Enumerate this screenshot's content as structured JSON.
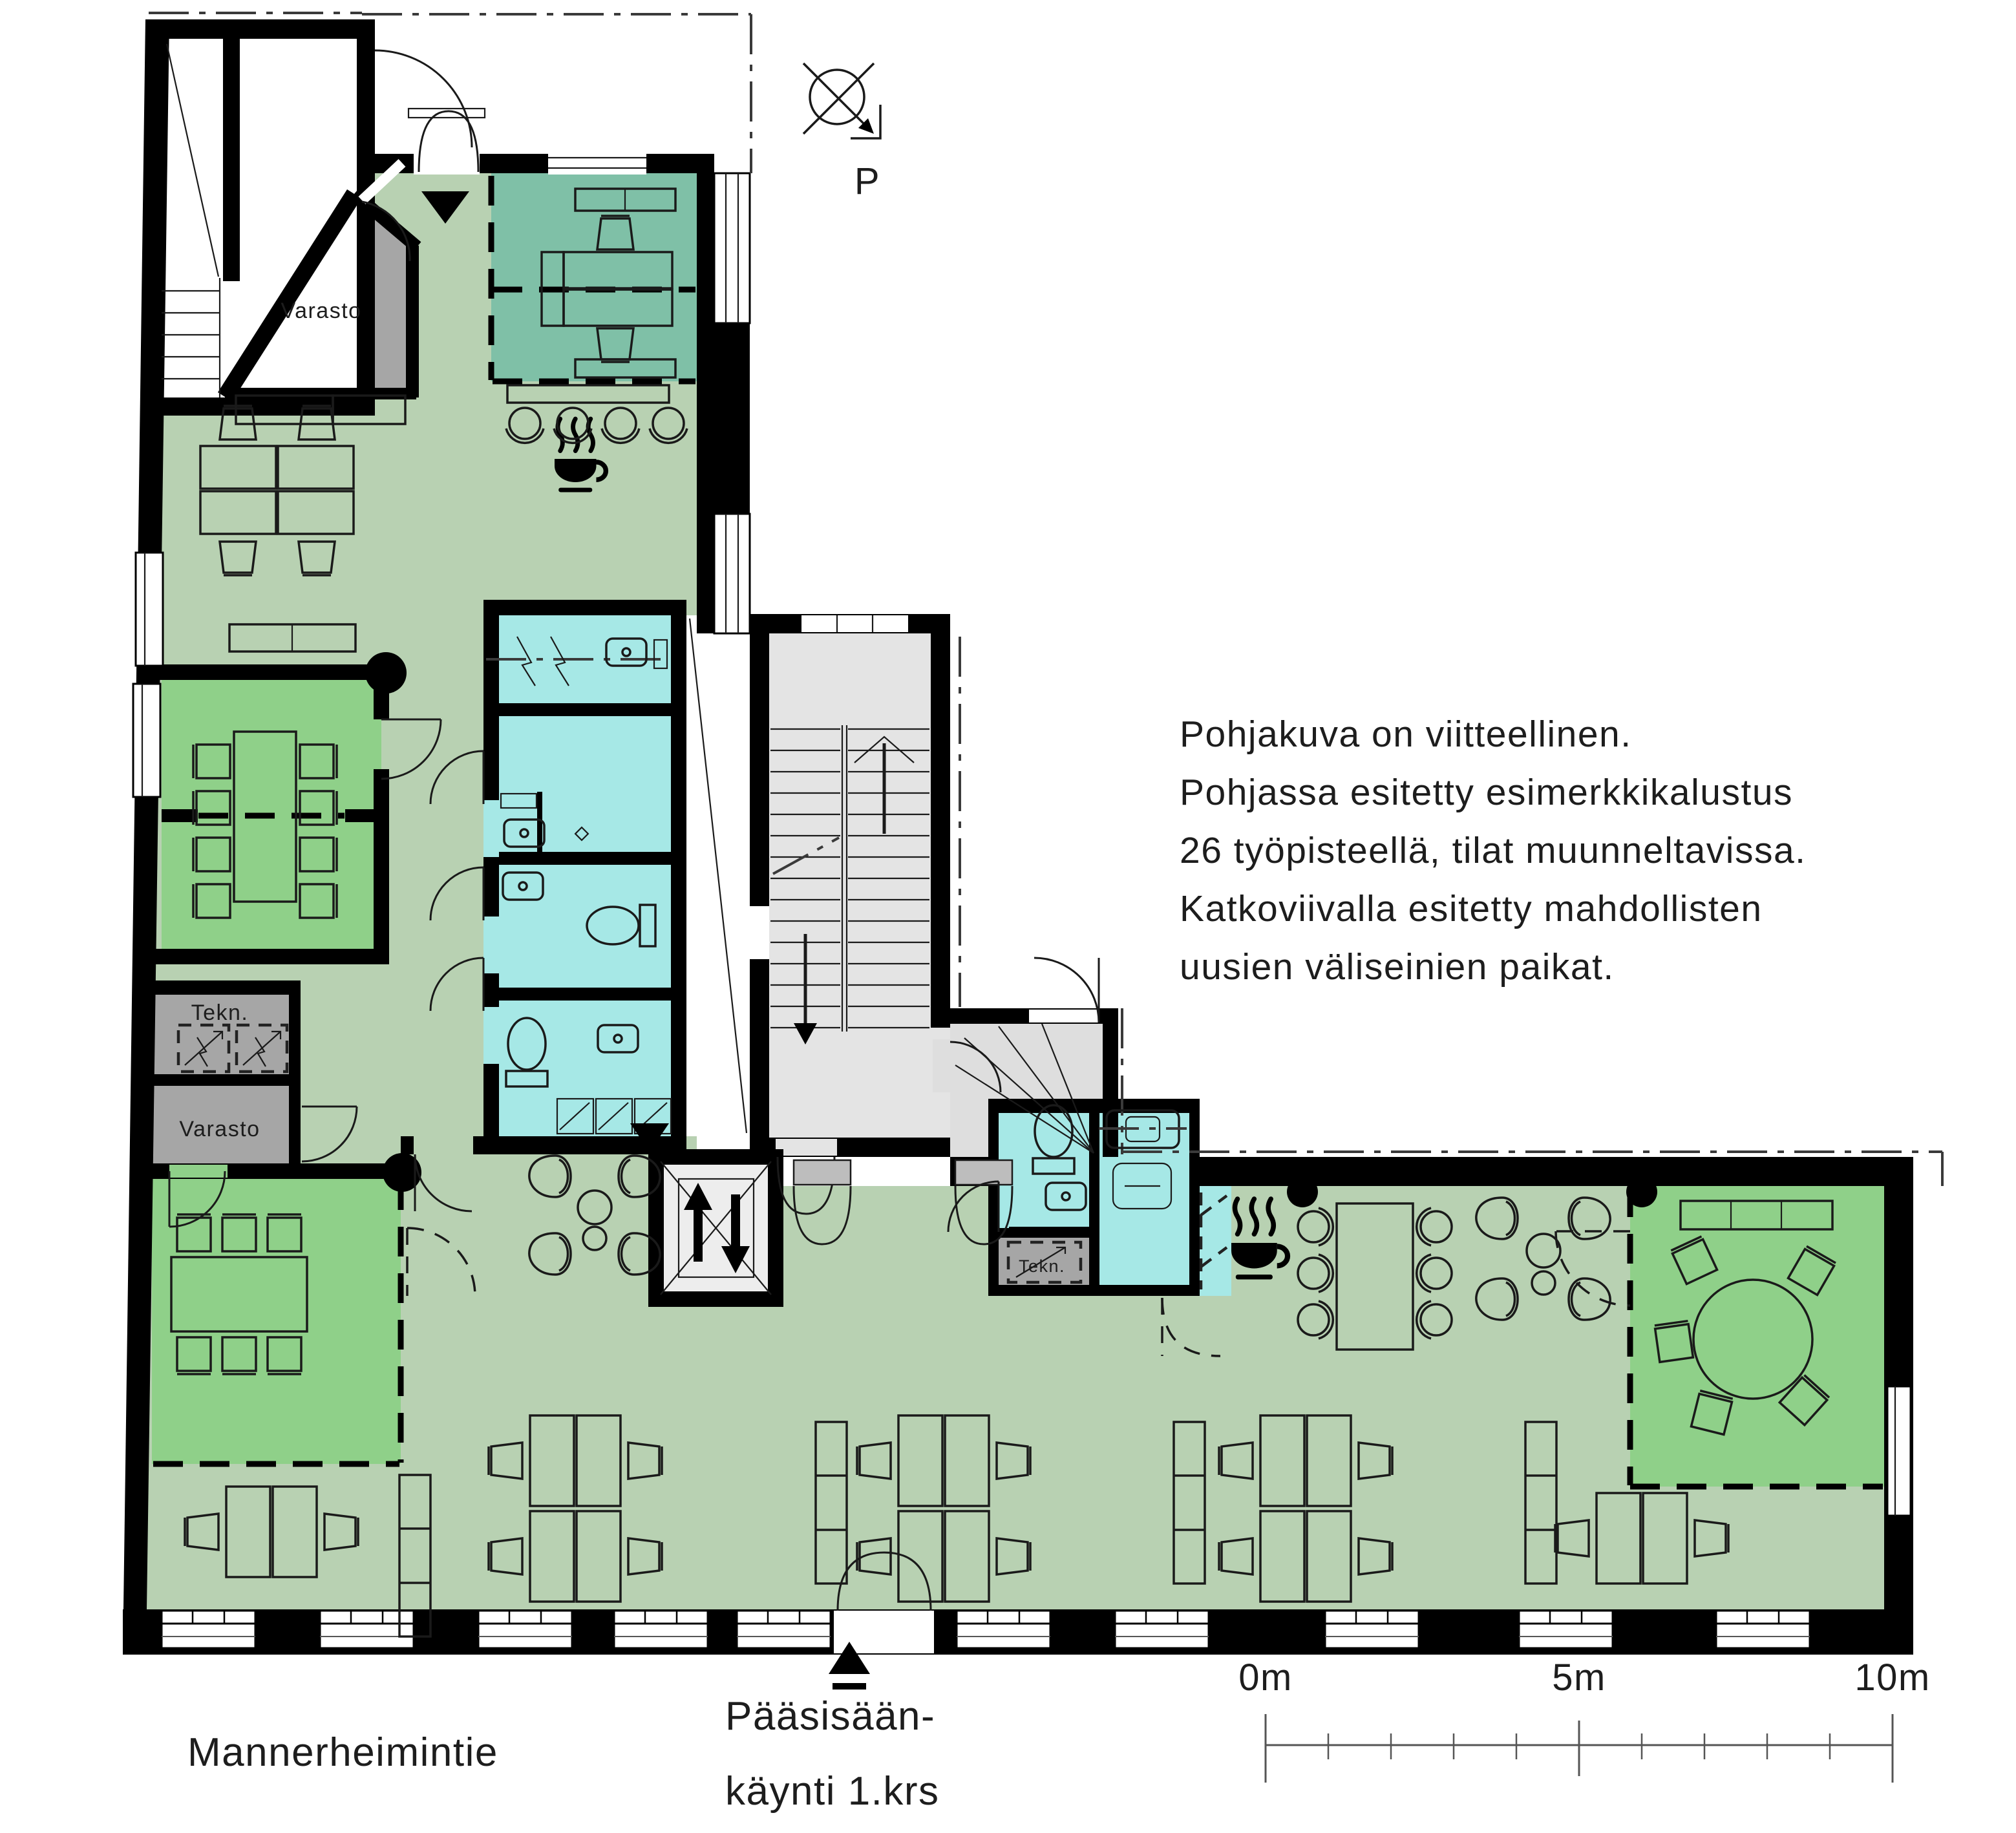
{
  "annotation": {
    "lines": [
      "Pohjakuva on viitteellinen.",
      "Pohjassa esitetty esimerkkikalustus",
      "26 työpisteellä, tilat muunneltavissa.",
      "Katkoviivalla esitetty mahdollisten",
      "uusien väliseinien paikat."
    ]
  },
  "labels": {
    "varasto_upper": "Varasto",
    "tekn_left": "Tekn.",
    "varasto_lower": "Varasto",
    "tekn_right": "Tekn.",
    "street": "Mannerheimintie",
    "entrance_1": "Pääsisään-",
    "entrance_2": "käynti 1.krs",
    "north": "P"
  },
  "scale_bar": {
    "labels": [
      "0m",
      "5m",
      "10m"
    ]
  },
  "colors": {
    "open_office_green": "#b8d1b2",
    "meeting_room_green": "#8fd089",
    "focus_room_teal": "#7fc0a7",
    "wet_room_cyan": "#a6e8e6",
    "service_gray": "#a6a6a6",
    "circulation_gray": "#e4e4e4",
    "door_leaf_gray": "#bdbdbd",
    "wall_black": "#000000"
  },
  "icons": {
    "coffee_point": "coffee-cup-icon",
    "north_arrow": "crossed-circle-arrow-icon",
    "entrance_marker": "filled-triangle-icon",
    "elevator": "up-down-arrow-icon",
    "electrical_cabinet": "dashed-box-lightning-icon"
  }
}
